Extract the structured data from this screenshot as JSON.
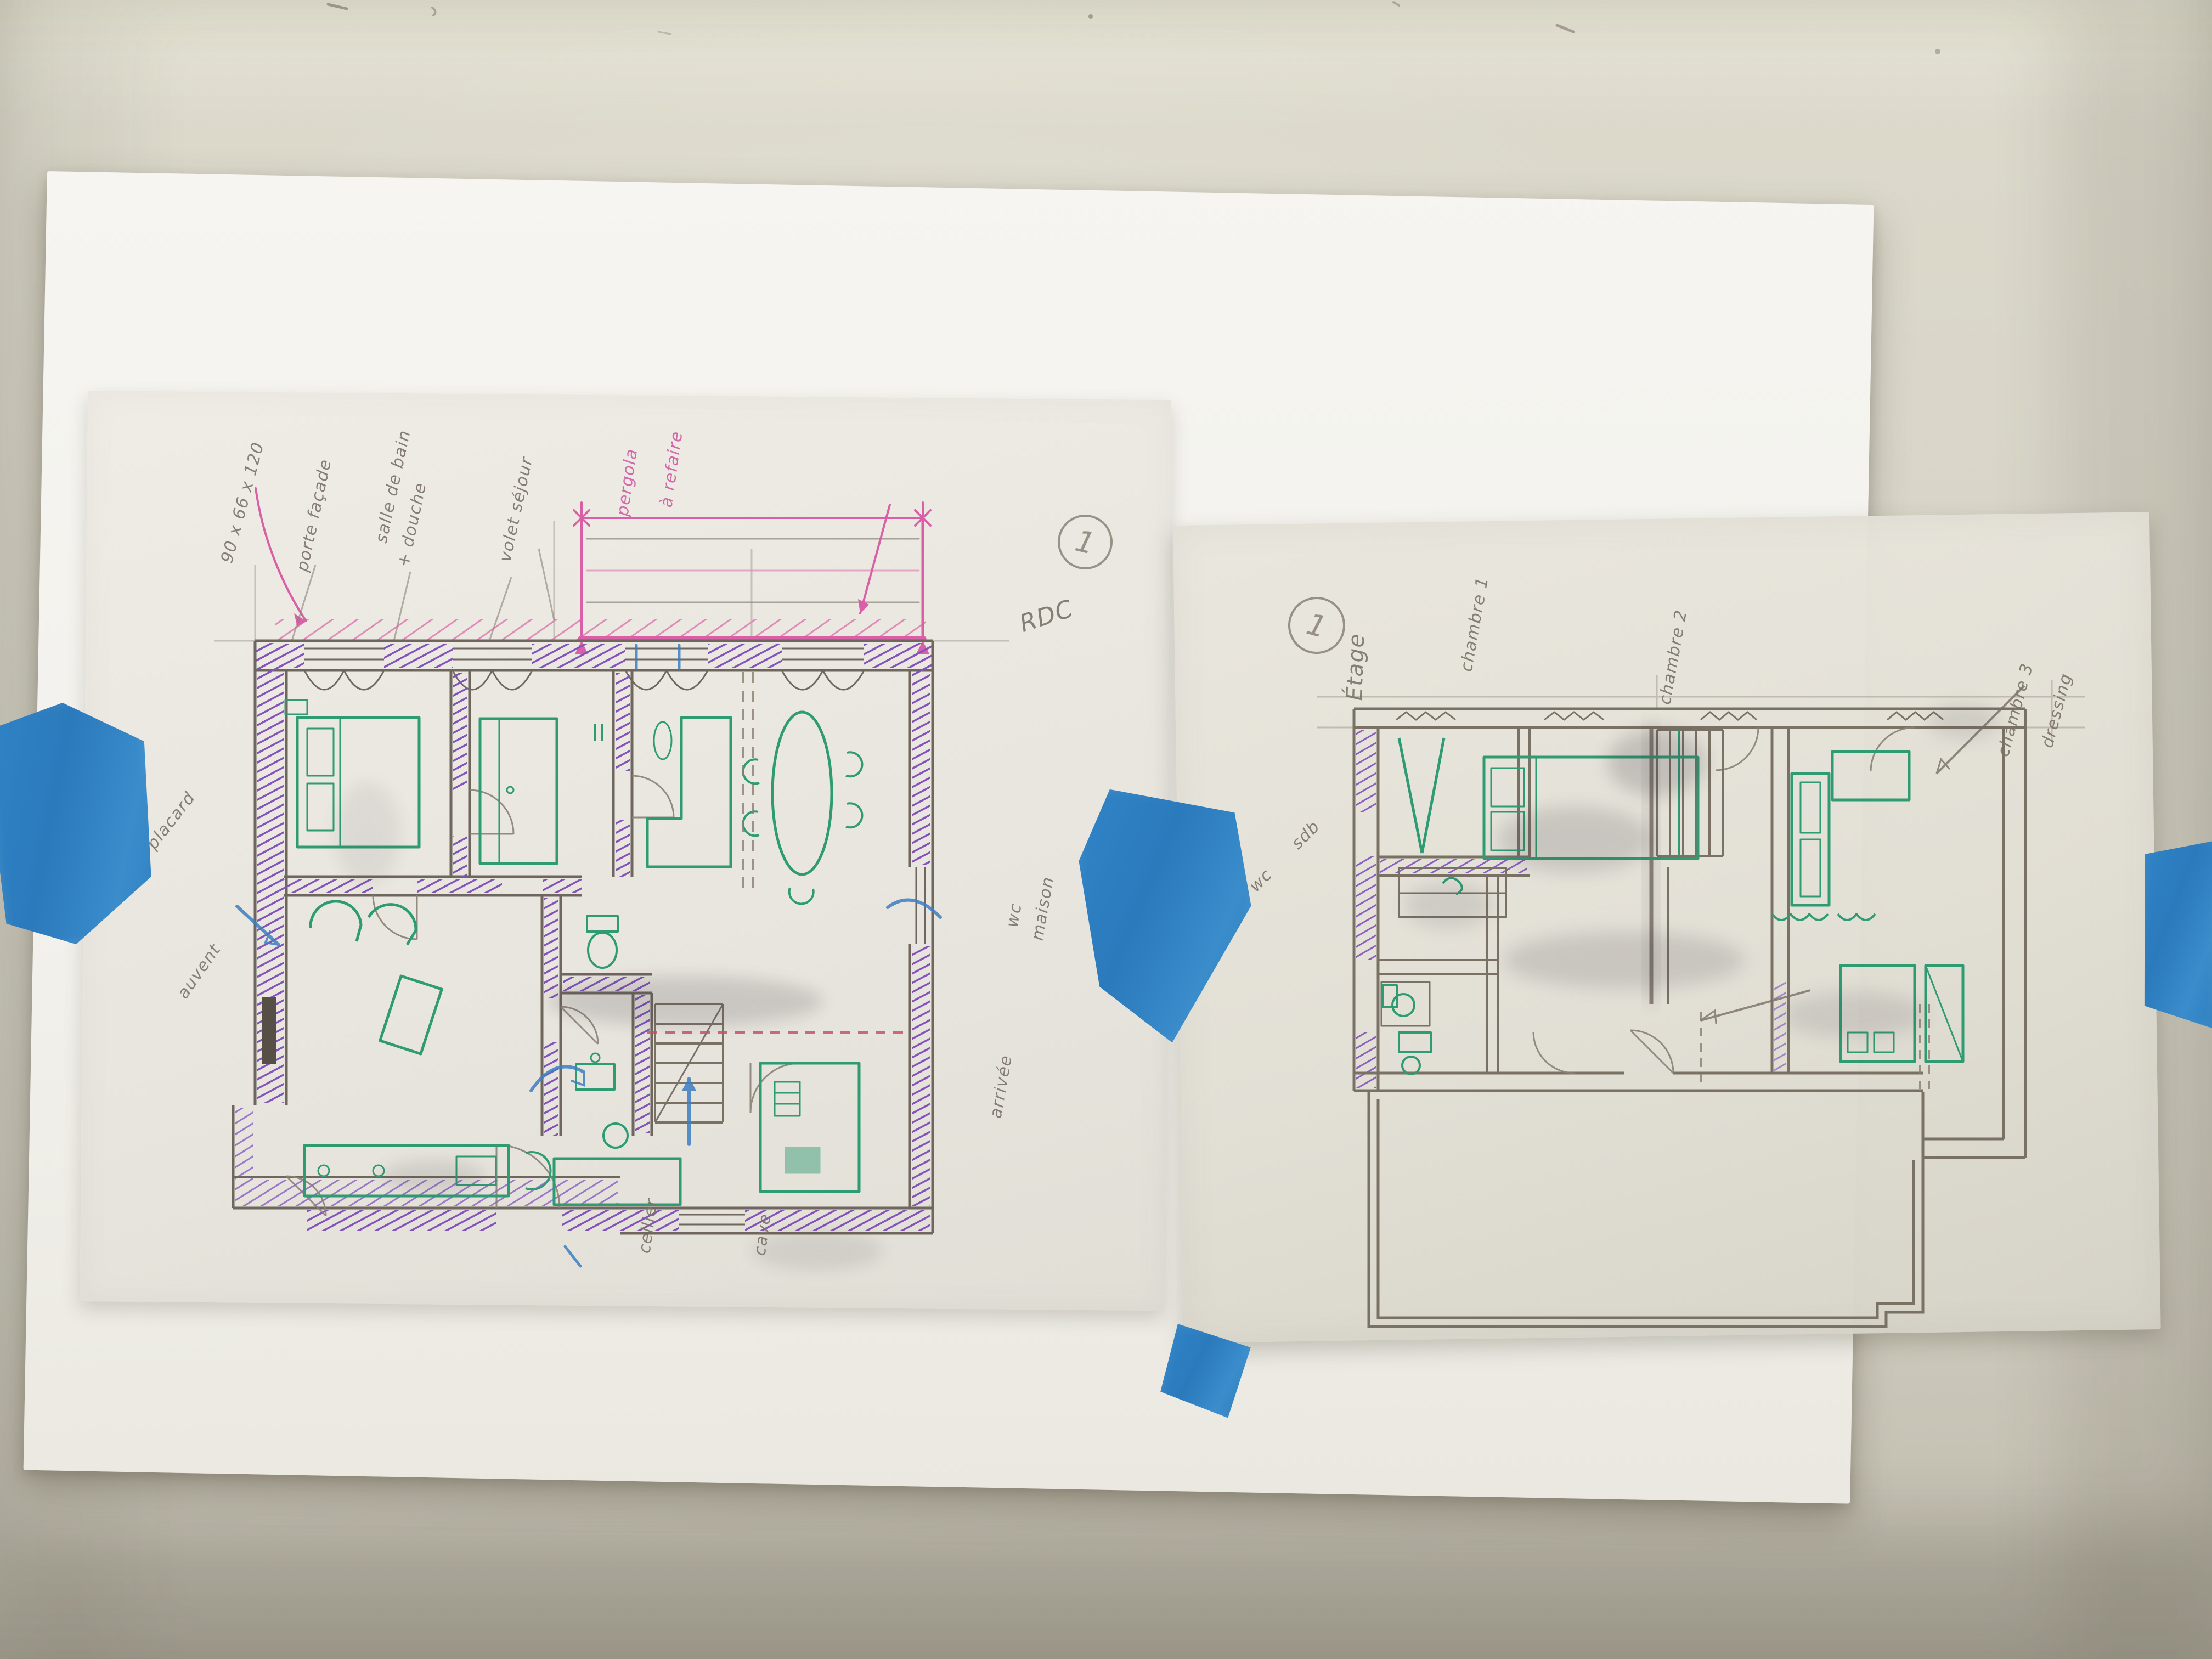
{
  "scene": {
    "description": "Two hand-drawn floor plan sketches on tracing paper taped to a wall",
    "wall_color": "#d7d4c8",
    "backing_sheet_color": "#f4f3ef",
    "tracing_sheet_color": "#ebe9e1",
    "tape_color": "#2e80c2"
  },
  "plan_colors": {
    "wall_purple": "#7b4fb8",
    "furniture_green": "#2e9b72",
    "pencil_gray": "#6f675d",
    "terrace_pink": "#d95fa6",
    "pen_blue": "#3c7ec2",
    "dashed_red": "#c25568"
  },
  "left_sheet": {
    "floor_label": "RDC",
    "page_number": "1",
    "annotations": {
      "dim_note": "90 x 66 x 120",
      "note_facade": "porte façade",
      "note_bain1": "salle de bain",
      "note_bain2": "+ douche",
      "note_volet": "volet séjour",
      "pergola1": "pergola",
      "pergola2": "à refaire",
      "placard": "placard",
      "auvent": "auvent",
      "wc": "wc",
      "maison": "maison",
      "arrivee": "arrivée",
      "cellier": "cellier",
      "cave": "cave"
    }
  },
  "right_sheet": {
    "floor_label": "Étage",
    "page_number": "1",
    "annotations": {
      "chambre1": "chambre 1",
      "chambre2": "chambre 2",
      "chambre3": "chambre 3",
      "dressing": "dressing",
      "wc": "wc",
      "sdb": "sdb"
    }
  }
}
